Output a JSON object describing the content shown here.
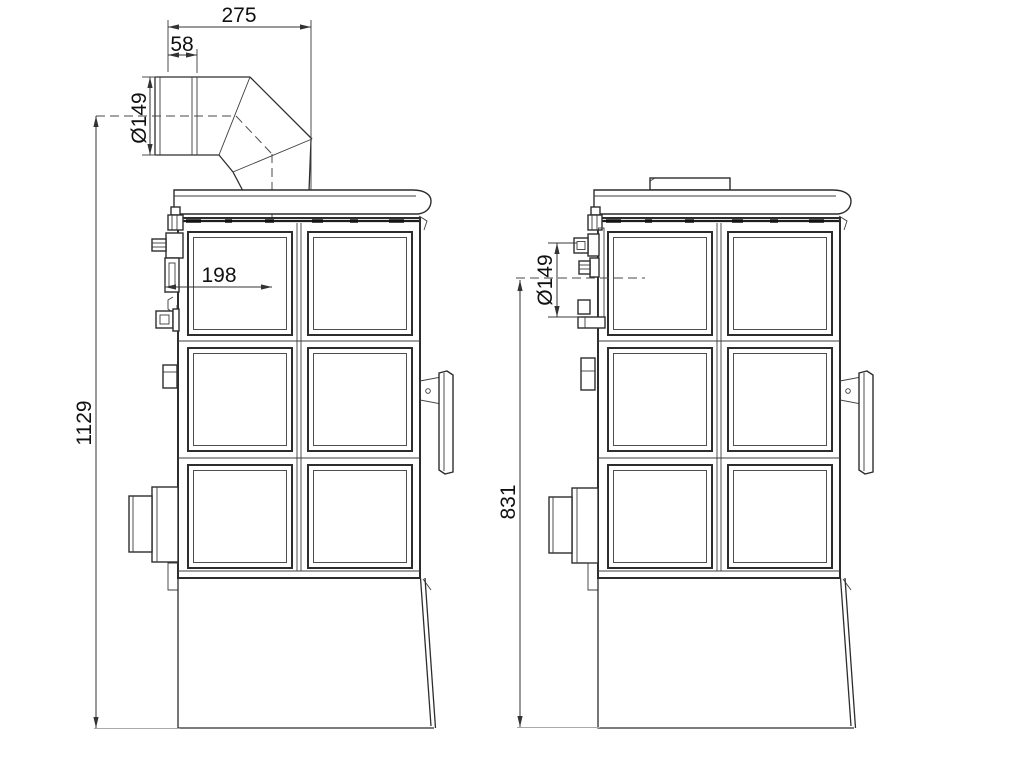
{
  "drawing": {
    "background": "#ffffff",
    "line_color": "#2d2d2d",
    "dimension_color": "#333333",
    "text_color": "#111111"
  },
  "dims": {
    "pipe_total": "275",
    "pipe_socket": "58",
    "pipe_diameter": "Ø149",
    "pipe_center_offset": "198",
    "overall_height_to_flue_center": "1129",
    "rear_outlet_diameter": "Ø149",
    "rear_outlet_center_height": "831"
  }
}
